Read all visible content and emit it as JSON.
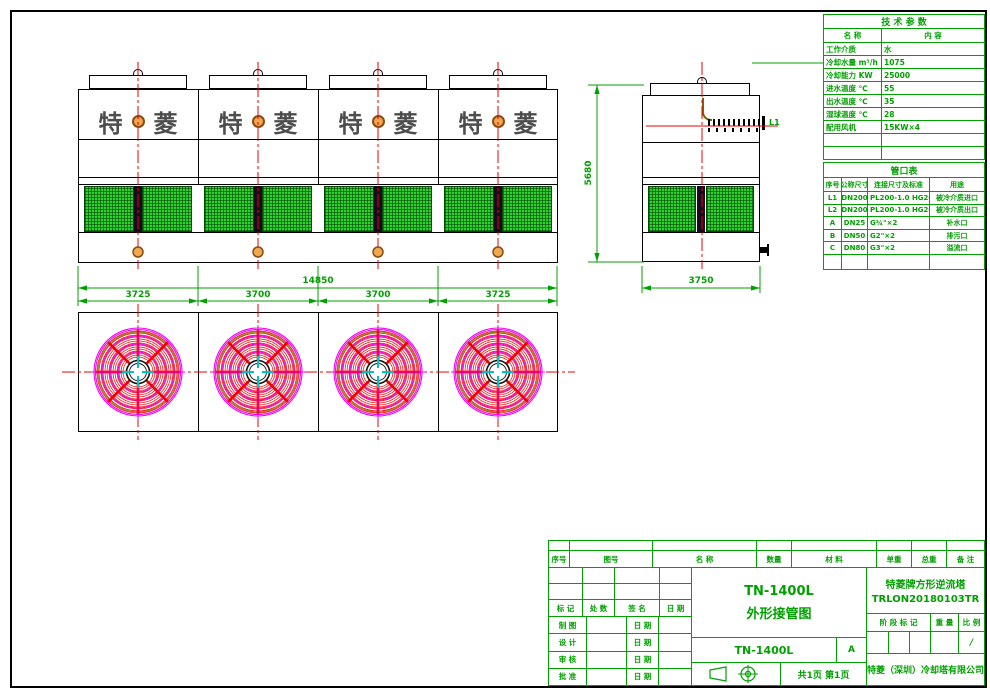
{
  "colors": {
    "line_green": "#00a000",
    "centerline_red": "#e80000",
    "louver_green": "#2fd32f",
    "fan_magenta": "#f000f0",
    "fan_red": "#ee0000",
    "logo_gray": "#4d4d4d",
    "nozzle_orange": "#f0a850"
  },
  "drawing": {
    "logo_char1": "特",
    "logo_char2": "菱",
    "dim_total": "14850",
    "dim_segments": [
      "3725",
      "3700",
      "3700",
      "3725"
    ],
    "dim_height": "5680",
    "dim_side_width": "3750",
    "side_pipe_label": "L1"
  },
  "tech_table": {
    "title": "技 术 参 数",
    "col_name": "名  称",
    "col_content": "内  容",
    "rows": [
      {
        "label": "工作介质",
        "value": "水"
      },
      {
        "label": "冷却水量 m³/h",
        "value": "1075"
      },
      {
        "label": "冷却能力  KW",
        "value": "25000"
      },
      {
        "label": "进水温度  ℃",
        "value": "55"
      },
      {
        "label": "出水温度  ℃",
        "value": "35"
      },
      {
        "label": "湿球温度  ℃",
        "value": "28"
      },
      {
        "label": "配用风机",
        "value": "15KW×4"
      },
      {
        "label": "",
        "value": ""
      },
      {
        "label": "",
        "value": ""
      }
    ]
  },
  "port_table": {
    "title": "管口表",
    "headers": [
      "序号",
      "公称尺寸",
      "连接尺寸及标准",
      "用途"
    ],
    "rows": [
      [
        "L1",
        "DN200",
        "PL200-1.0 HG20593",
        "被冷介质进口"
      ],
      [
        "L2",
        "DN200",
        "PL200-1.0 HG20593",
        "被冷介质出口"
      ],
      [
        "A",
        "DN25",
        "G¾\"×2",
        "补水口"
      ],
      [
        "B",
        "DN50",
        "G2\"×2",
        "排污口"
      ],
      [
        "C",
        "DN80",
        "G3\"×2",
        "溢流口"
      ],
      [
        "",
        "",
        "",
        ""
      ]
    ]
  },
  "title_block": {
    "bom_headers": [
      "序号",
      "图号",
      "名  称",
      "数量",
      "材  料",
      "单重",
      "总重",
      "备 注"
    ],
    "sig_headers": [
      "标 记",
      "处 数",
      "签  名",
      "日  期"
    ],
    "sig_rows": [
      {
        "label": "制 图",
        "date_label": "日 期"
      },
      {
        "label": "设 计",
        "date_label": "日 期"
      },
      {
        "label": "审 核",
        "date_label": "日 期"
      },
      {
        "label": "批 准",
        "date_label": "日 期"
      }
    ],
    "title_line1": "TN-1400L",
    "title_line2": "外形接管图",
    "model": "TN-1400L",
    "rev": "A",
    "pages": "共1页 第1页",
    "product_name": "特菱牌方形逆流塔",
    "drawing_no": "TRLON20180103TR",
    "stage_headers": [
      "阶 段 标 记",
      "重 量",
      "比 例"
    ],
    "scale_value": "/",
    "company": "特菱（深圳）冷却塔有限公司"
  }
}
